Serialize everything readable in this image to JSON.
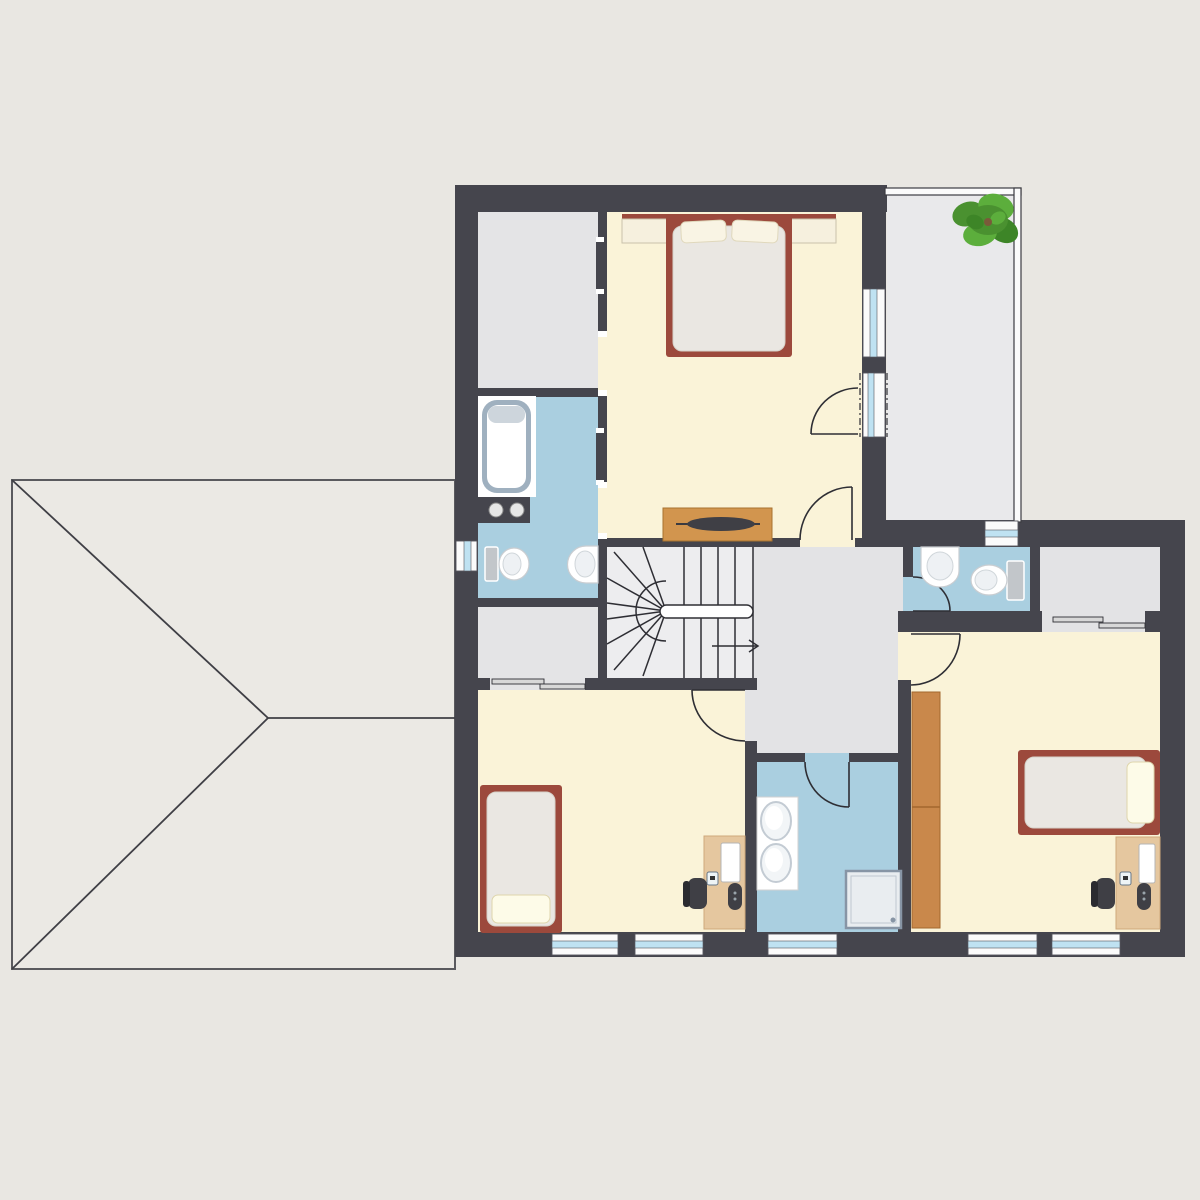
{
  "title": "Upper floor plan with garage roof",
  "diagram_type": "architectural-floor-plan",
  "palette": {
    "bg": "#e9e7e2",
    "roof": "#ebe9e4",
    "wall": "#45454d",
    "line_dark": "#2e2e34",
    "cream": "#faf3d8",
    "bath_blue": "#aacfe0",
    "hall_gray": "#e3e3e5",
    "closet_gray": "#e4e4e6",
    "stair_gray": "#ededef",
    "balcony_gray": "#e9e9eb",
    "window_blue": "#bfe2f2",
    "bed_frame": "#9c493c",
    "mattress": "#eae7e2",
    "pillow": "#f9f4e4",
    "pillow_bright": "#fdfbe8",
    "dresser_wood": "#d2954e",
    "wardrobe_wood": "#c9884b",
    "desk_wood": "#e5c79f",
    "dark_obj": "#3f3f45",
    "tub_edge": "#9fb0bf",
    "fixture_gray": "#c2c6ca",
    "shower_edge": "#8795a5",
    "plant_green": "#4a9130",
    "plant_green_light": "#5cae3c",
    "plant_green_dark": "#3d8527"
  },
  "rooms": [
    {
      "id": "master-bedroom",
      "floor": "cream",
      "furniture": [
        "double-bed",
        "two-pillows",
        "headboard-shelf",
        "nightstand-left",
        "nightstand-right",
        "sideboard-with-tv"
      ]
    },
    {
      "id": "walk-in-closet-top-left",
      "floor": "closet_gray",
      "furniture": []
    },
    {
      "id": "ensuite-bathroom",
      "floor": "bath_blue",
      "furniture": [
        "bathtub",
        "washer-with-knobs",
        "toilet",
        "wall-sink"
      ]
    },
    {
      "id": "closet-lower-left",
      "floor": "closet_gray",
      "furniture": []
    },
    {
      "id": "staircase",
      "floor": "stair_gray",
      "furniture": [
        "winder-stairs",
        "handrail",
        "direction-arrow-right"
      ]
    },
    {
      "id": "hallway",
      "floor": "hall_gray",
      "furniture": []
    },
    {
      "id": "wc",
      "floor": "bath_blue",
      "furniture": [
        "pedestal-sink",
        "toilet"
      ]
    },
    {
      "id": "storage-room",
      "floor": "hall_gray",
      "furniture": []
    },
    {
      "id": "bedroom-left",
      "floor": "cream",
      "furniture": [
        "single-bed",
        "pillow",
        "desk",
        "monitor",
        "office-chair"
      ]
    },
    {
      "id": "bathroom-lower",
      "floor": "bath_blue",
      "furniture": [
        "double-sink-vanity",
        "shower"
      ]
    },
    {
      "id": "bedroom-right",
      "floor": "cream",
      "furniture": [
        "single-bed",
        "pillow",
        "wardrobe",
        "desk",
        "monitor",
        "office-chair"
      ]
    },
    {
      "id": "balcony",
      "floor": "balcony_gray",
      "furniture": [
        "potted-plant"
      ]
    },
    {
      "id": "garage-roof",
      "floor": "roof",
      "furniture": []
    }
  ],
  "doors": {
    "hinged": [
      "master-bedroom-hall-door",
      "master-bedroom-balcony-door",
      "bedroom-left-door",
      "bathroom-lower-door",
      "wc-door",
      "bedroom-right-door"
    ],
    "sliding": [
      "closet-lower-left-sliding-door",
      "storage-room-sliding-door",
      "master-closet-pocket-door",
      "ensuite-pocket-door"
    ]
  },
  "windows_count": 8,
  "stairs": {
    "type": "u-shaped-winder",
    "arrow_direction": "right"
  }
}
